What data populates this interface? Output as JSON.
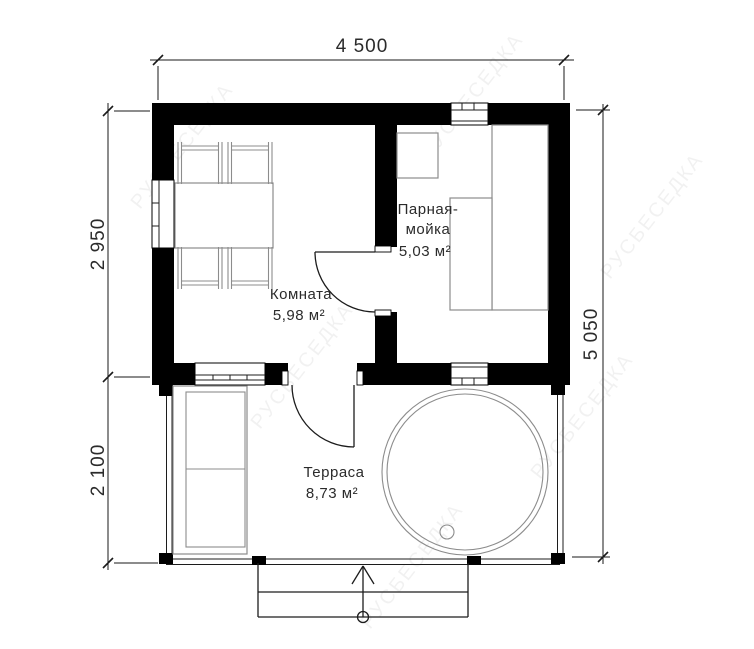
{
  "dimensions": {
    "top_width": "4 500",
    "left_upper_height": "2 950",
    "left_lower_height": "2 100",
    "right_total_height": "5 050"
  },
  "rooms": {
    "komnata": {
      "name": "Комната",
      "area": "5,98 м²"
    },
    "parnaya": {
      "name_line1": "Парная-",
      "name_line2": "мойка",
      "area": "5,03 м²"
    },
    "terrasa": {
      "name": "Терраса",
      "area": "8,73 м²"
    }
  },
  "watermark": {
    "text": "РУСБЕСЕДКА"
  },
  "colors": {
    "wall": "#000000",
    "drawing_line": "#1c1c1c",
    "furniture_line": "#8c8c8c",
    "text": "#2b2b2b",
    "background": "#ffffff"
  }
}
